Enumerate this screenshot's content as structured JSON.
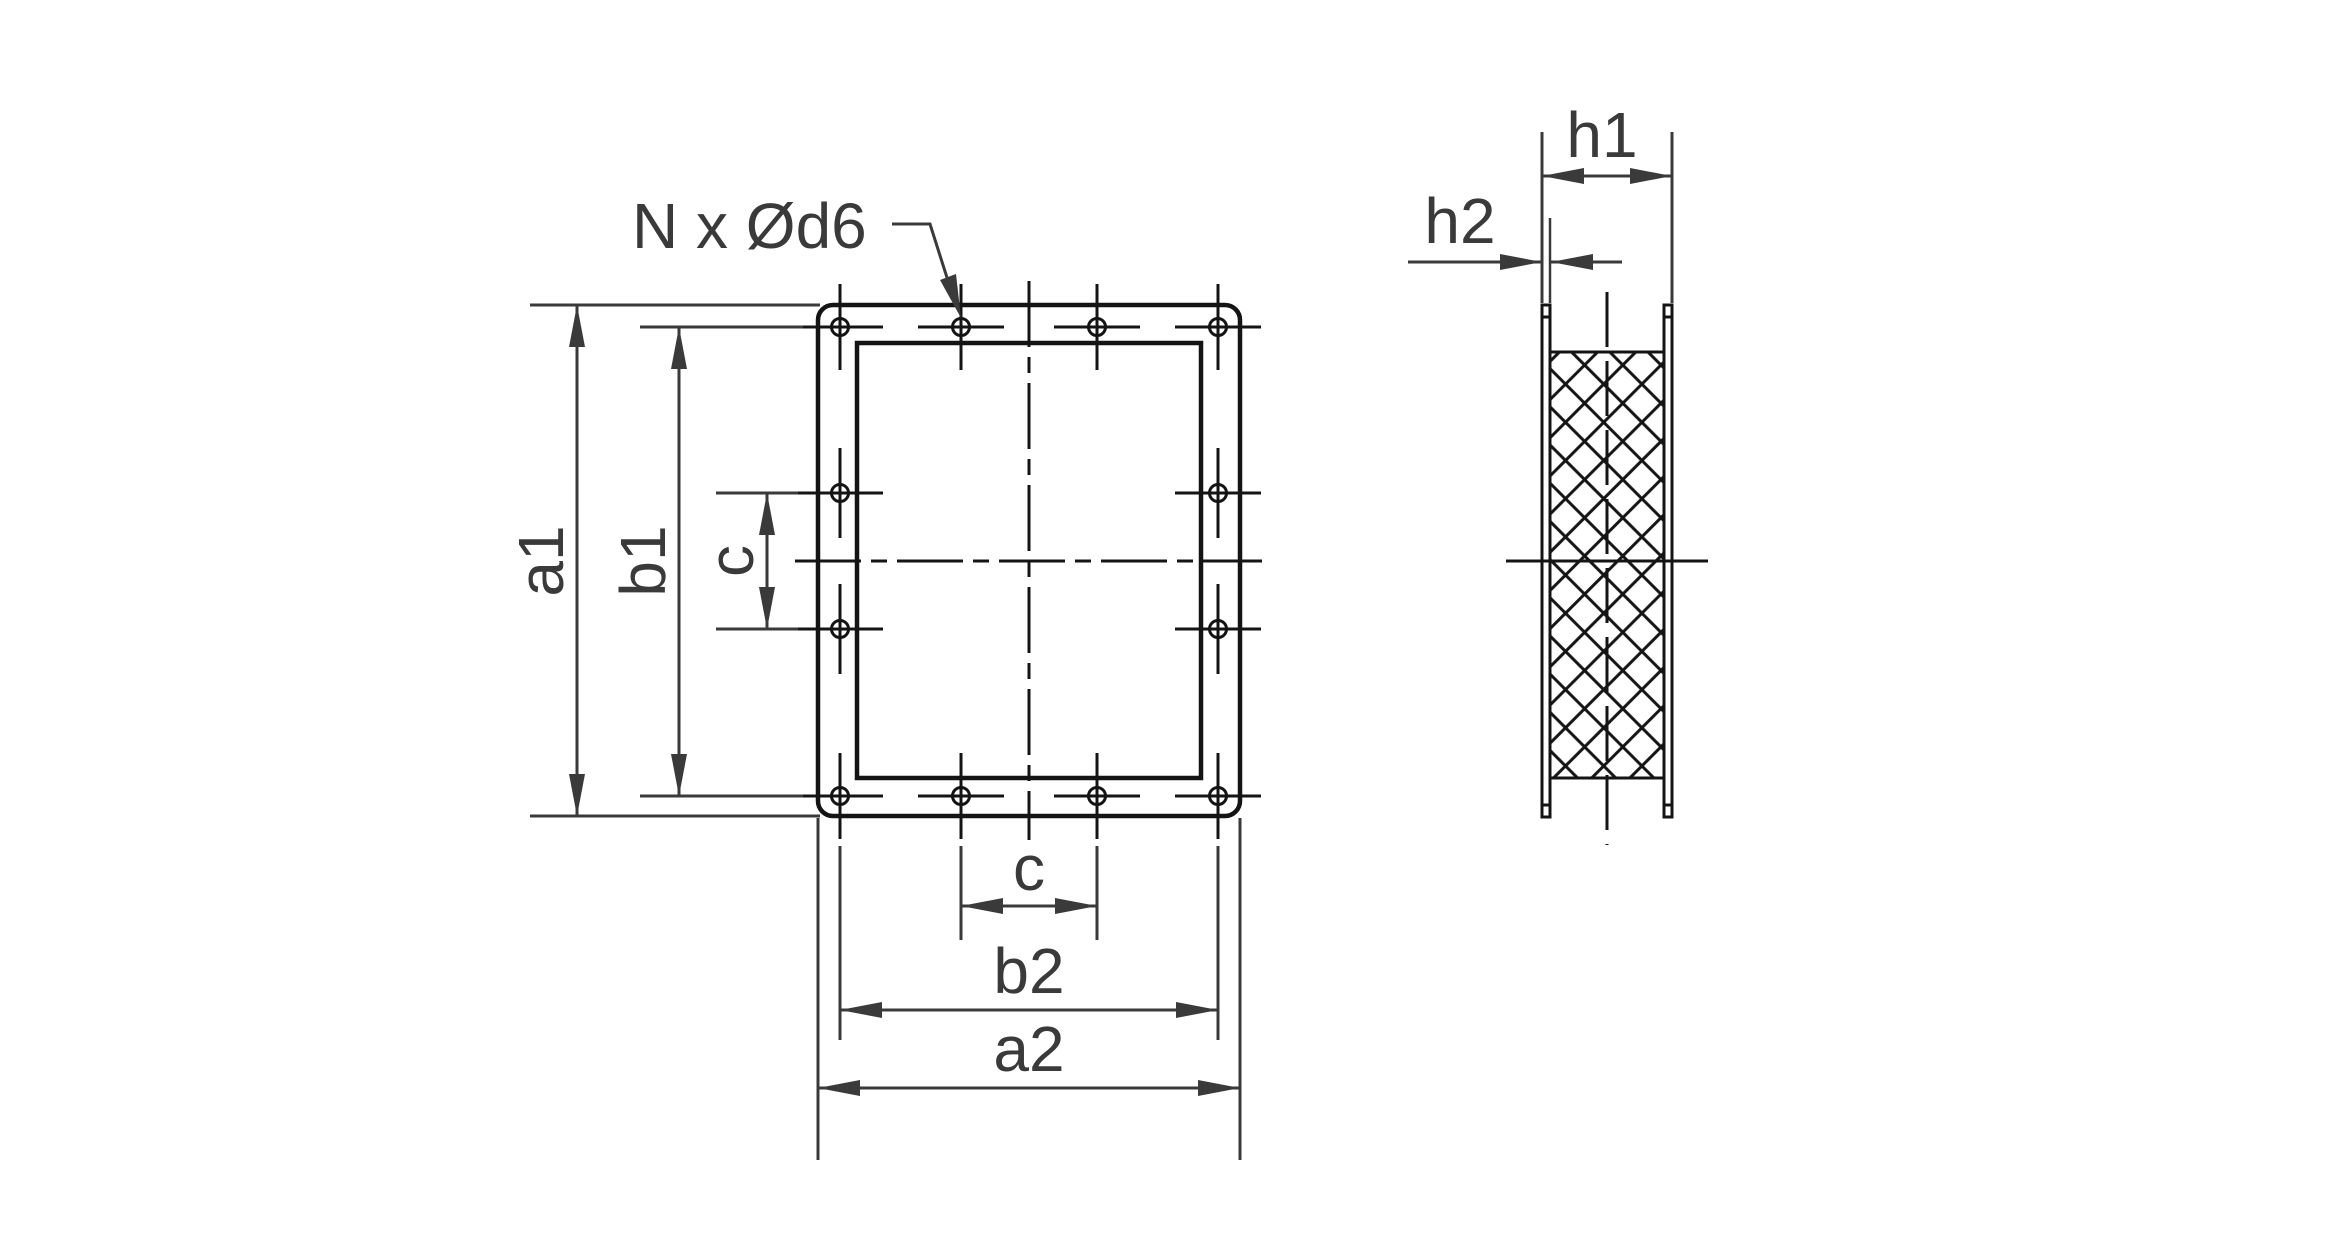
{
  "page": {
    "background": "#ffffff"
  },
  "drawing": {
    "type": "technical-drawing",
    "views": [
      "front-view",
      "side-section-view"
    ],
    "line_color": "#141414",
    "dim_color": "#3a3a3a",
    "labels": {
      "hole_note": "N x Ød6",
      "a1": "a1",
      "b1": "b1",
      "c_vertical": "c",
      "c_horizontal": "c",
      "b2": "b2",
      "a2": "a2",
      "h1": "h1",
      "h2": "h2"
    },
    "front_view": {
      "bolt_hole_count": 12,
      "hole_rows": {
        "top_row_holes": 4,
        "bottom_row_holes": 4,
        "left_side_holes": 2,
        "right_side_holes": 2
      }
    }
  }
}
